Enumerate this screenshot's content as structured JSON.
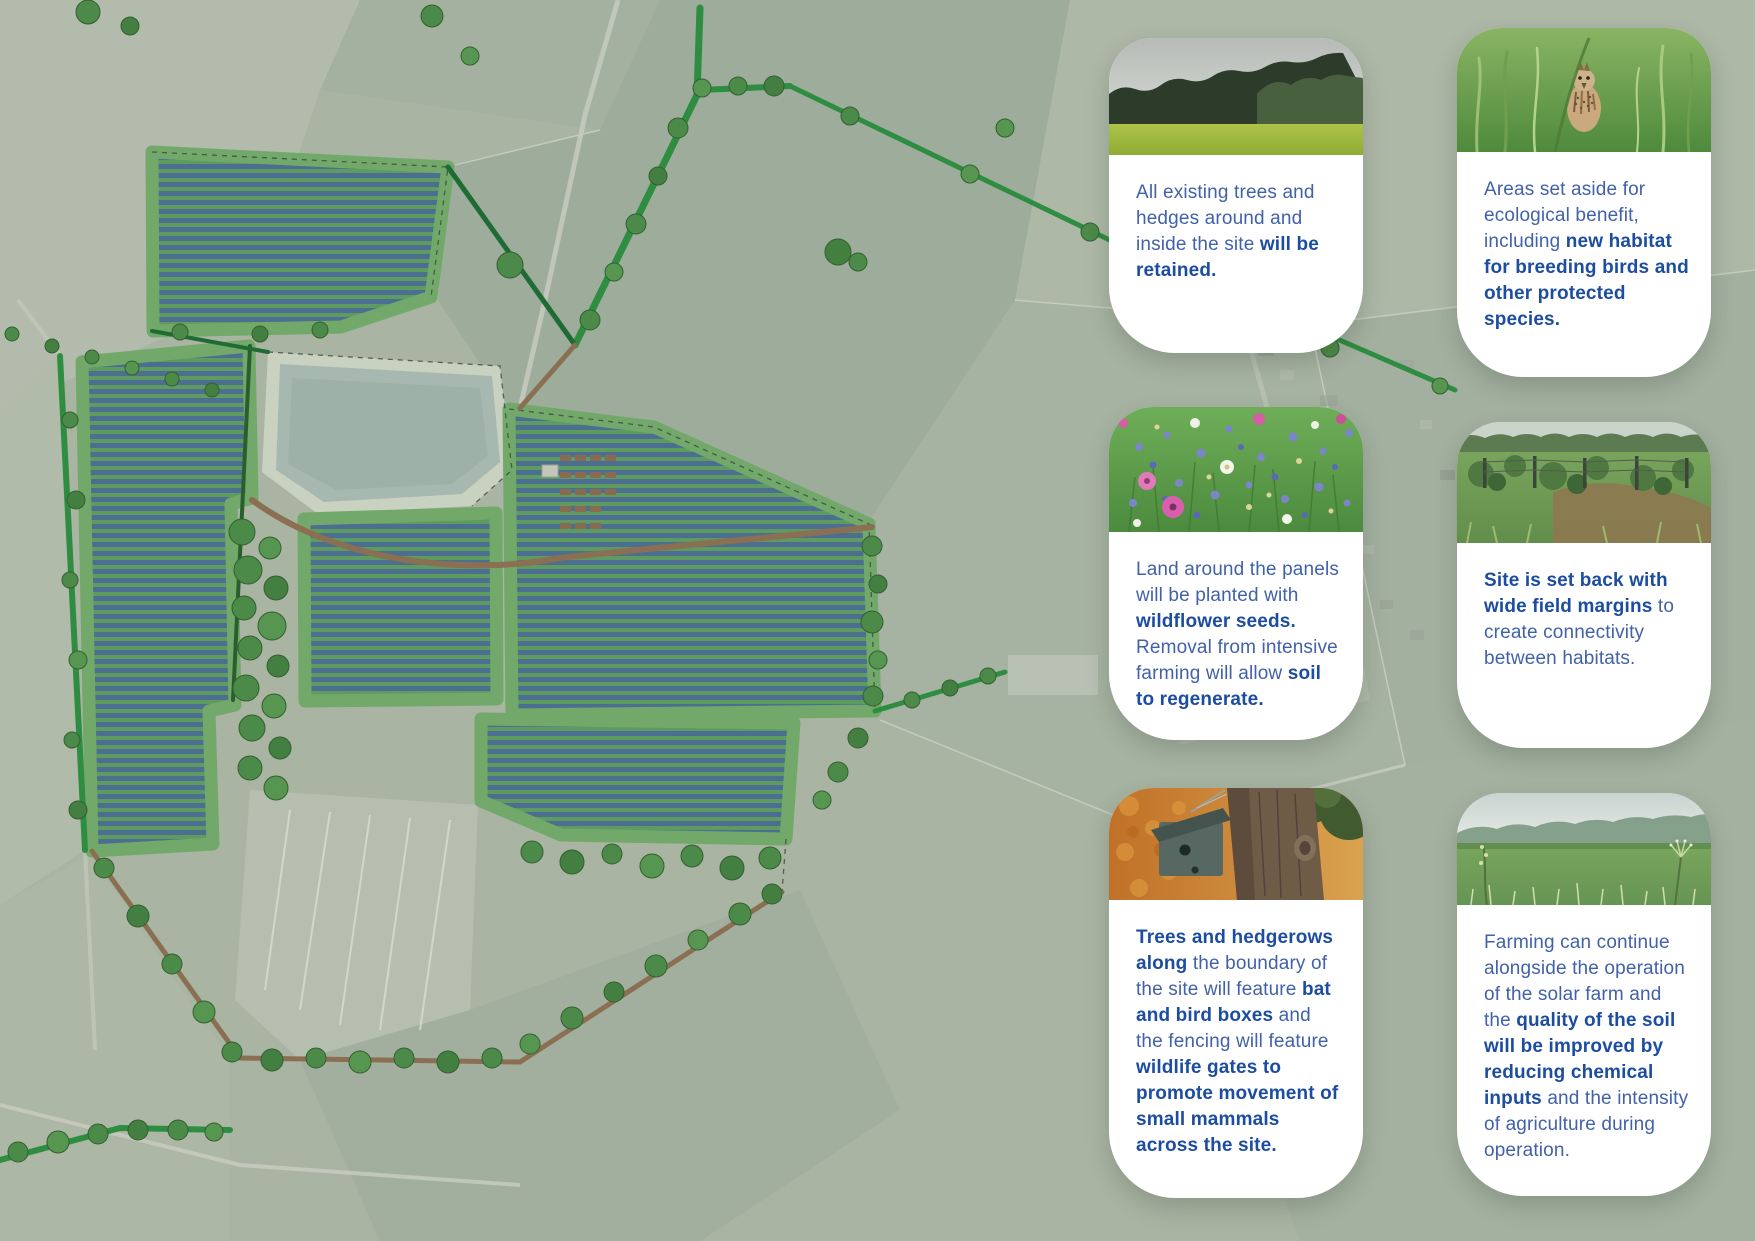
{
  "canvas": {
    "width": 1755,
    "height": 1241
  },
  "colors": {
    "card_background": "#ffffff",
    "text_regular": "#4161a9",
    "text_bold": "#1c4da1",
    "map_base_green": "#a9b4a3",
    "site_grass_green": "#72a96b",
    "solar_panel_blue": "#4c6f91",
    "hedgerow_green": "#2e8d40",
    "pond_grey_green": "#a7b8b1",
    "track_brown": "#8a6f52"
  },
  "map": {
    "name": "solar-farm-aerial-masterplan"
  },
  "cards": [
    {
      "id": "trees-retained",
      "photo": "treeline-and-field-photo",
      "segments": [
        {
          "text": "All existing trees and hedges around and inside the site ",
          "bold": false
        },
        {
          "text": "will be retained.",
          "bold": true
        }
      ]
    },
    {
      "id": "ecological-areas",
      "photo": "skylark-in-grass-photo",
      "segments": [
        {
          "text": "Areas set aside for ecological benefit, including ",
          "bold": false
        },
        {
          "text": "new habitat for breeding birds and other protected species.",
          "bold": true
        }
      ]
    },
    {
      "id": "wildflower-seeds",
      "photo": "wildflower-meadow-photo",
      "segments": [
        {
          "text": "Land around the panels will be planted with ",
          "bold": false
        },
        {
          "text": "wildflower seeds.",
          "bold": true
        },
        {
          "text": " Removal from intensive farming will allow ",
          "bold": false
        },
        {
          "text": "soil to regenerate.",
          "bold": true
        }
      ]
    },
    {
      "id": "field-margins",
      "photo": "field-margin-fence-photo",
      "segments": [
        {
          "text": "Site is set back with wide field margins",
          "bold": true
        },
        {
          "text": " to create connectivity between habitats.",
          "bold": false
        }
      ]
    },
    {
      "id": "bat-bird-boxes",
      "photo": "bird-box-on-tree-photo",
      "segments": [
        {
          "text": "Trees and hedgerows along",
          "bold": true
        },
        {
          "text": " the boundary of the site will feature ",
          "bold": false
        },
        {
          "text": "bat and bird boxes",
          "bold": true
        },
        {
          "text": " and the fencing will feature ",
          "bold": false
        },
        {
          "text": "wildlife gates to promote movement of small mammals across the site.",
          "bold": true
        }
      ]
    },
    {
      "id": "farming-continues",
      "photo": "green-field-photo",
      "segments": [
        {
          "text": "Farming can continue alongside the operation of the solar farm and the ",
          "bold": false
        },
        {
          "text": "quality of the soil will be improved by reducing chemical inputs",
          "bold": true
        },
        {
          "text": " and the intensity of agriculture during operation.",
          "bold": false
        }
      ]
    }
  ]
}
